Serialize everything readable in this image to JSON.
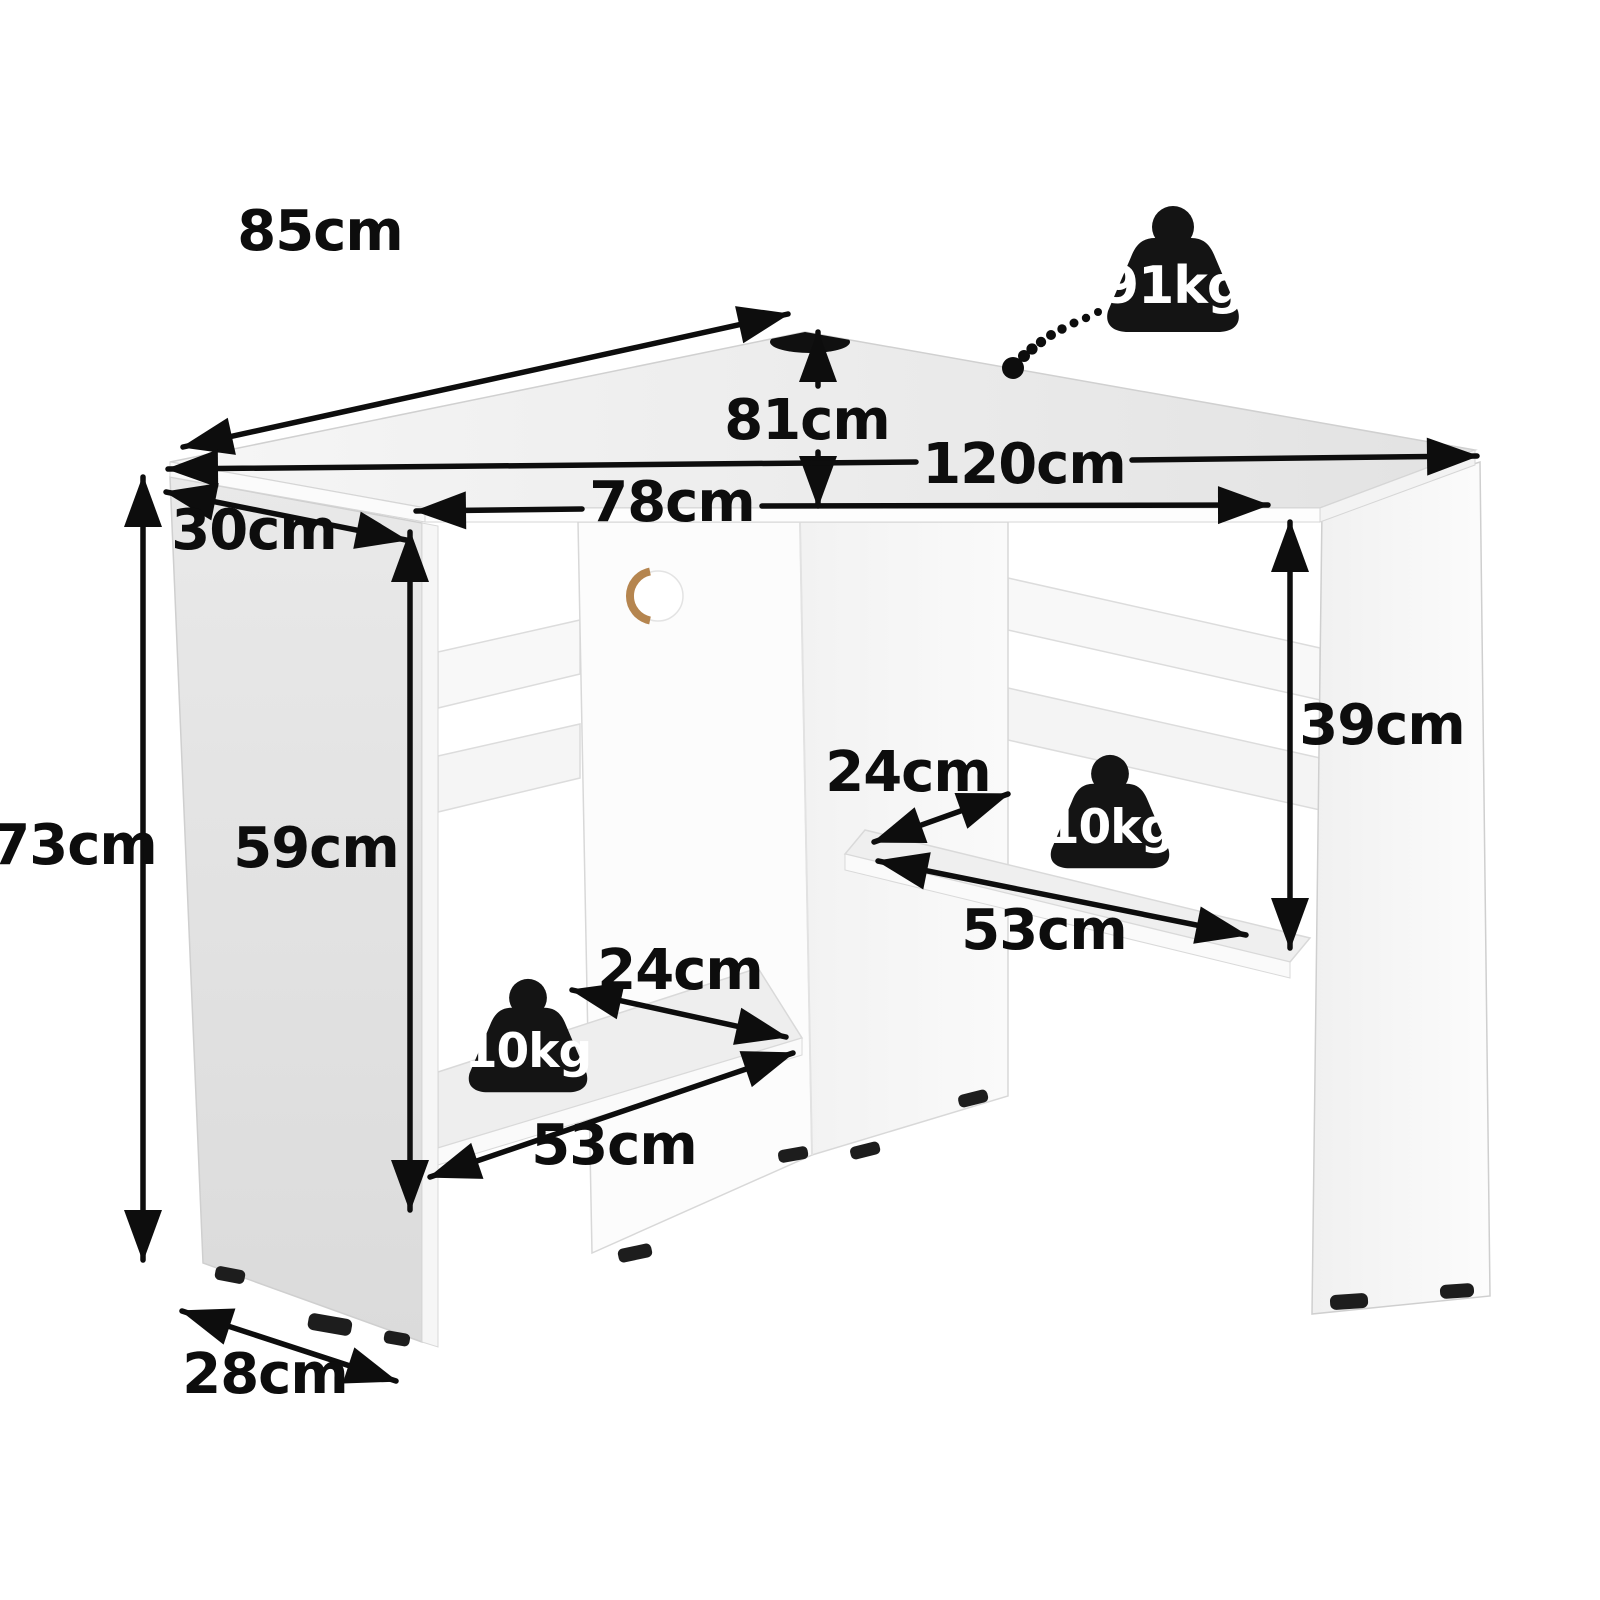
{
  "diagram": {
    "kind": "corner-desk-dimension-diagram",
    "units": "cm",
    "dimensions": [
      {
        "id": "back-left-edge",
        "label": "85cm"
      },
      {
        "id": "desktop-depth",
        "label": "81cm"
      },
      {
        "id": "back-width",
        "label": "120cm"
      },
      {
        "id": "front-width",
        "label": "78cm"
      },
      {
        "id": "left-side-depth",
        "label": "30cm"
      },
      {
        "id": "total-height",
        "label": "73cm"
      },
      {
        "id": "underdesk-clearance",
        "label": "59cm"
      },
      {
        "id": "right-shelf-to-top",
        "label": "39cm"
      },
      {
        "id": "right-shelf-depth",
        "label": "24cm"
      },
      {
        "id": "right-shelf-width",
        "label": "53cm"
      },
      {
        "id": "left-shelf-depth",
        "label": "24cm"
      },
      {
        "id": "left-shelf-width",
        "label": "53cm"
      },
      {
        "id": "base-depth",
        "label": "28cm"
      }
    ],
    "capacities": [
      {
        "id": "desktop-max-load",
        "label": "91kg"
      },
      {
        "id": "right-shelf-max-load",
        "label": "10kg"
      },
      {
        "id": "left-shelf-max-load",
        "label": "10kg"
      }
    ],
    "icons": {
      "weight_badge": "weight-kettlebell-icon"
    },
    "colors": {
      "background": "#ffffff",
      "annotation": "#0d0d0d",
      "desk_surface": "#ededed",
      "desk_panel_shade": "#e3e3e3",
      "desk_white": "#fbfbfb",
      "hole_cork": "#b5854f",
      "badge": "#141414",
      "badge_text": "#ffffff"
    }
  }
}
